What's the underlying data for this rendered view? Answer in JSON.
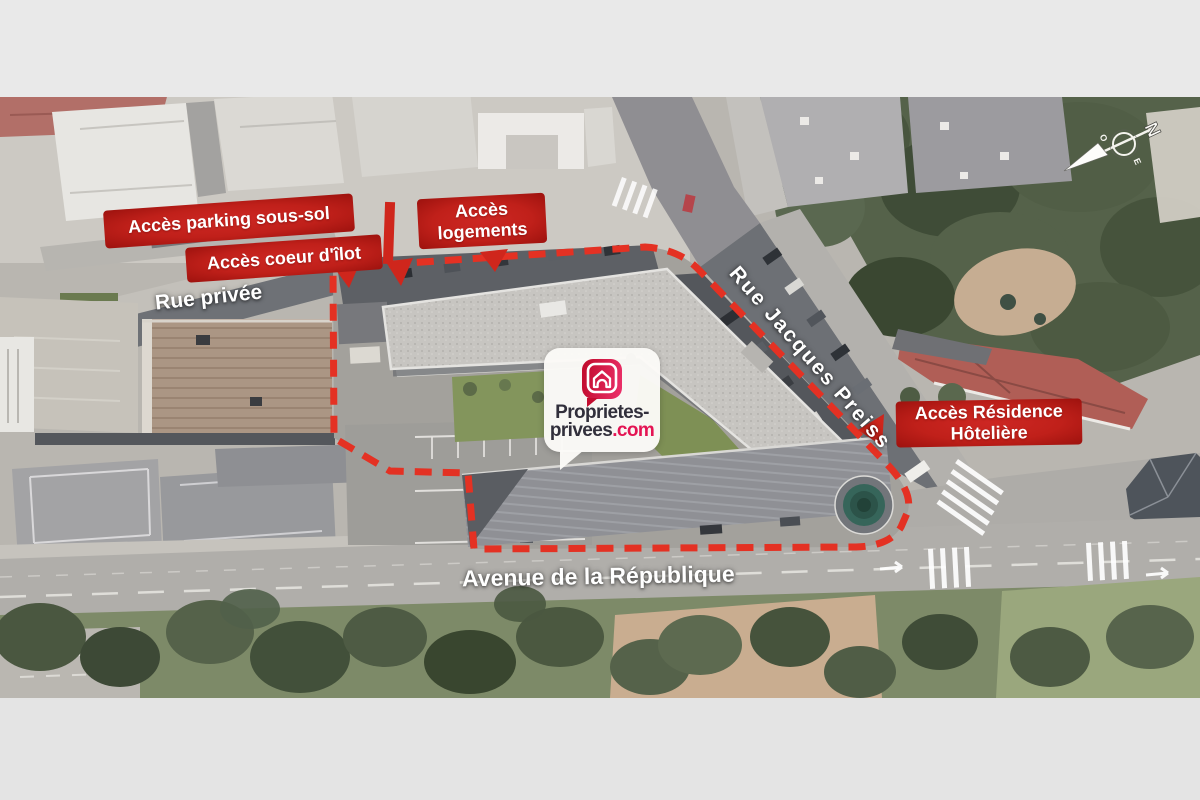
{
  "annotations": {
    "parking": "Accès parking sous-sol",
    "coeur_ilot": "Accès coeur d'îlot",
    "logements_l1": "Accès",
    "logements_l2": "logements",
    "residence_l1": "Accès Résidence",
    "residence_l2": "Hôtelière"
  },
  "streets": {
    "rue_privee": "Rue privée",
    "rue_jacques_preiss": "Rue Jacques Preiss",
    "avenue_republique": "Avenue de la République"
  },
  "logo": {
    "line1": "Proprietes-",
    "line2_dark": "privees",
    "line2_accent": ".com"
  },
  "compass": {
    "north": "N",
    "west": "O",
    "east": "E"
  },
  "colors": {
    "annotation_red": "#c0201a",
    "boundary_red": "#e43123",
    "logo_accent": "#e41453",
    "logo_dark": "#312f3b"
  }
}
